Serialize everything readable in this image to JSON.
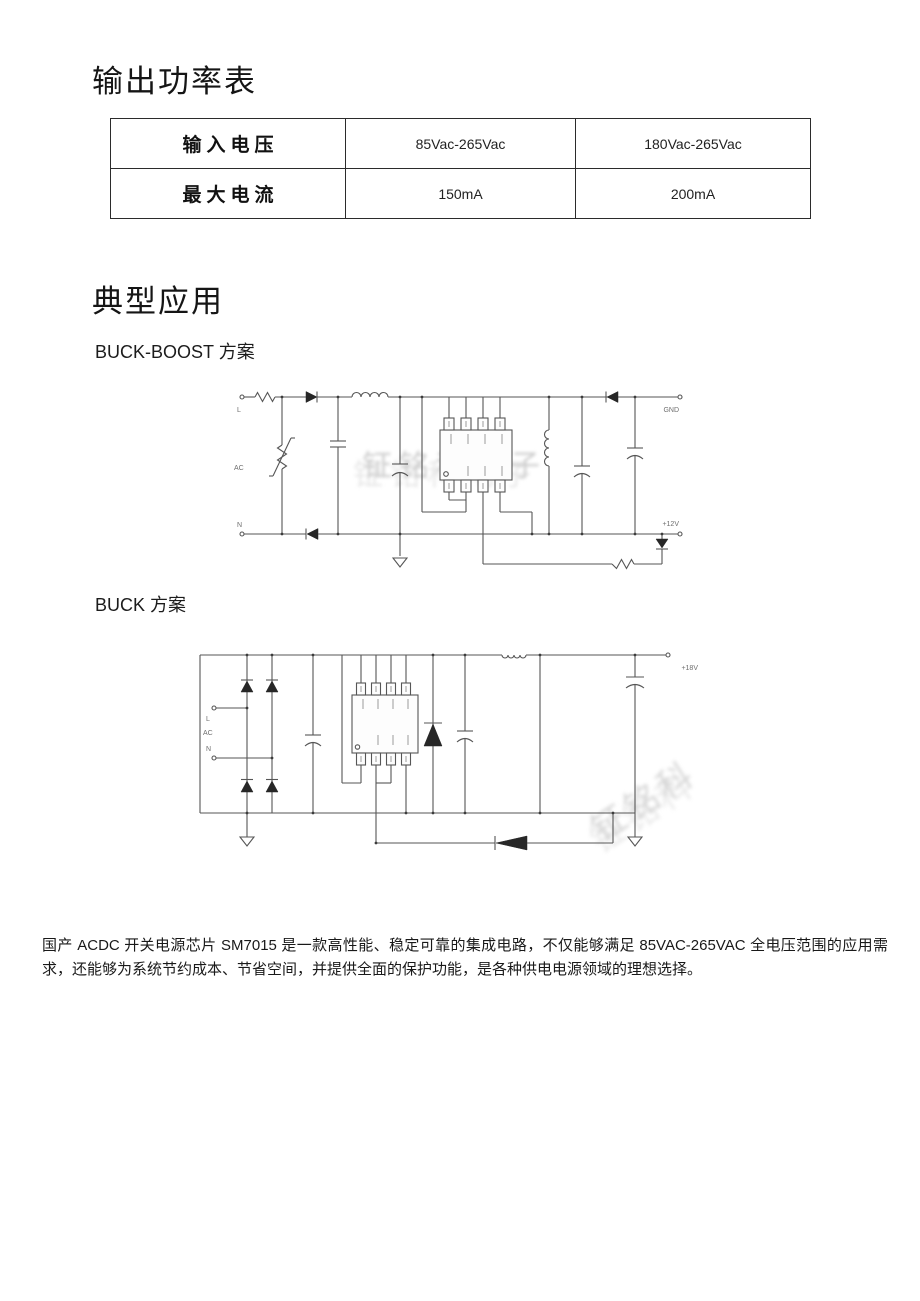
{
  "headings": {
    "output_power": "输出功率表",
    "typical_apps": "典型应用",
    "buckboost": "BUCK-BOOST 方案",
    "buck": "BUCK 方案"
  },
  "power_table": {
    "rows": [
      {
        "label": "输入电压",
        "v1": "85Vac-265Vac",
        "v2": "180Vac-265Vac"
      },
      {
        "label": "最大电流",
        "v1": "150mA",
        "v2": "200mA"
      }
    ]
  },
  "buckboost_circuit": {
    "labels": {
      "line": "L",
      "ac": "AC",
      "neutral": "N",
      "gnd": "GND",
      "vout": "+12V"
    },
    "watermark": "钲铭科电子"
  },
  "buck_circuit": {
    "labels": {
      "line": "L",
      "ac": "AC",
      "neutral": "N",
      "vout": "+18V"
    },
    "watermark": "钲铭科"
  },
  "footer": {
    "paragraph": "国产 ACDC 开关电源芯片 SM7015 是一款高性能、稳定可靠的集成电路，不仅能够满足 85VAC-265VAC 全电压范围的应用需求，还能够为系统节约成本、节省空间，并提供全面的保护功能，是各种供电电源领域的理想选择。"
  }
}
